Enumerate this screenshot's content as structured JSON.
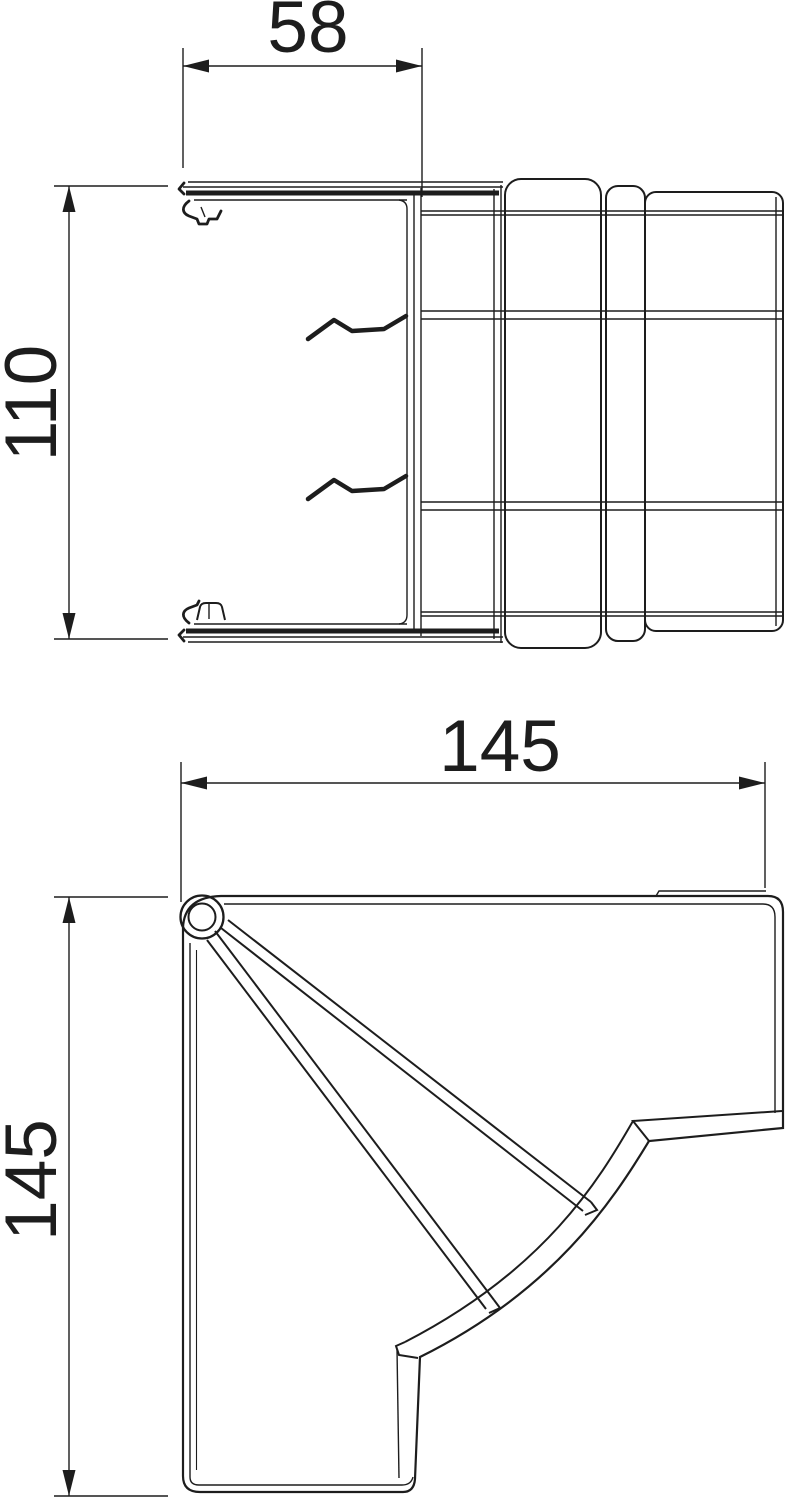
{
  "page": {
    "background_color": "#ffffff",
    "line_color": "#1d1d1d",
    "description_labels_visible": [
      "58",
      "110",
      "145",
      "145"
    ]
  },
  "views": {
    "top": {
      "width_dim": {
        "value": "58"
      },
      "height_dim": {
        "value": "110"
      }
    },
    "bottom": {
      "width_dim": {
        "value": "145"
      },
      "height_dim": {
        "value": "145"
      }
    }
  }
}
